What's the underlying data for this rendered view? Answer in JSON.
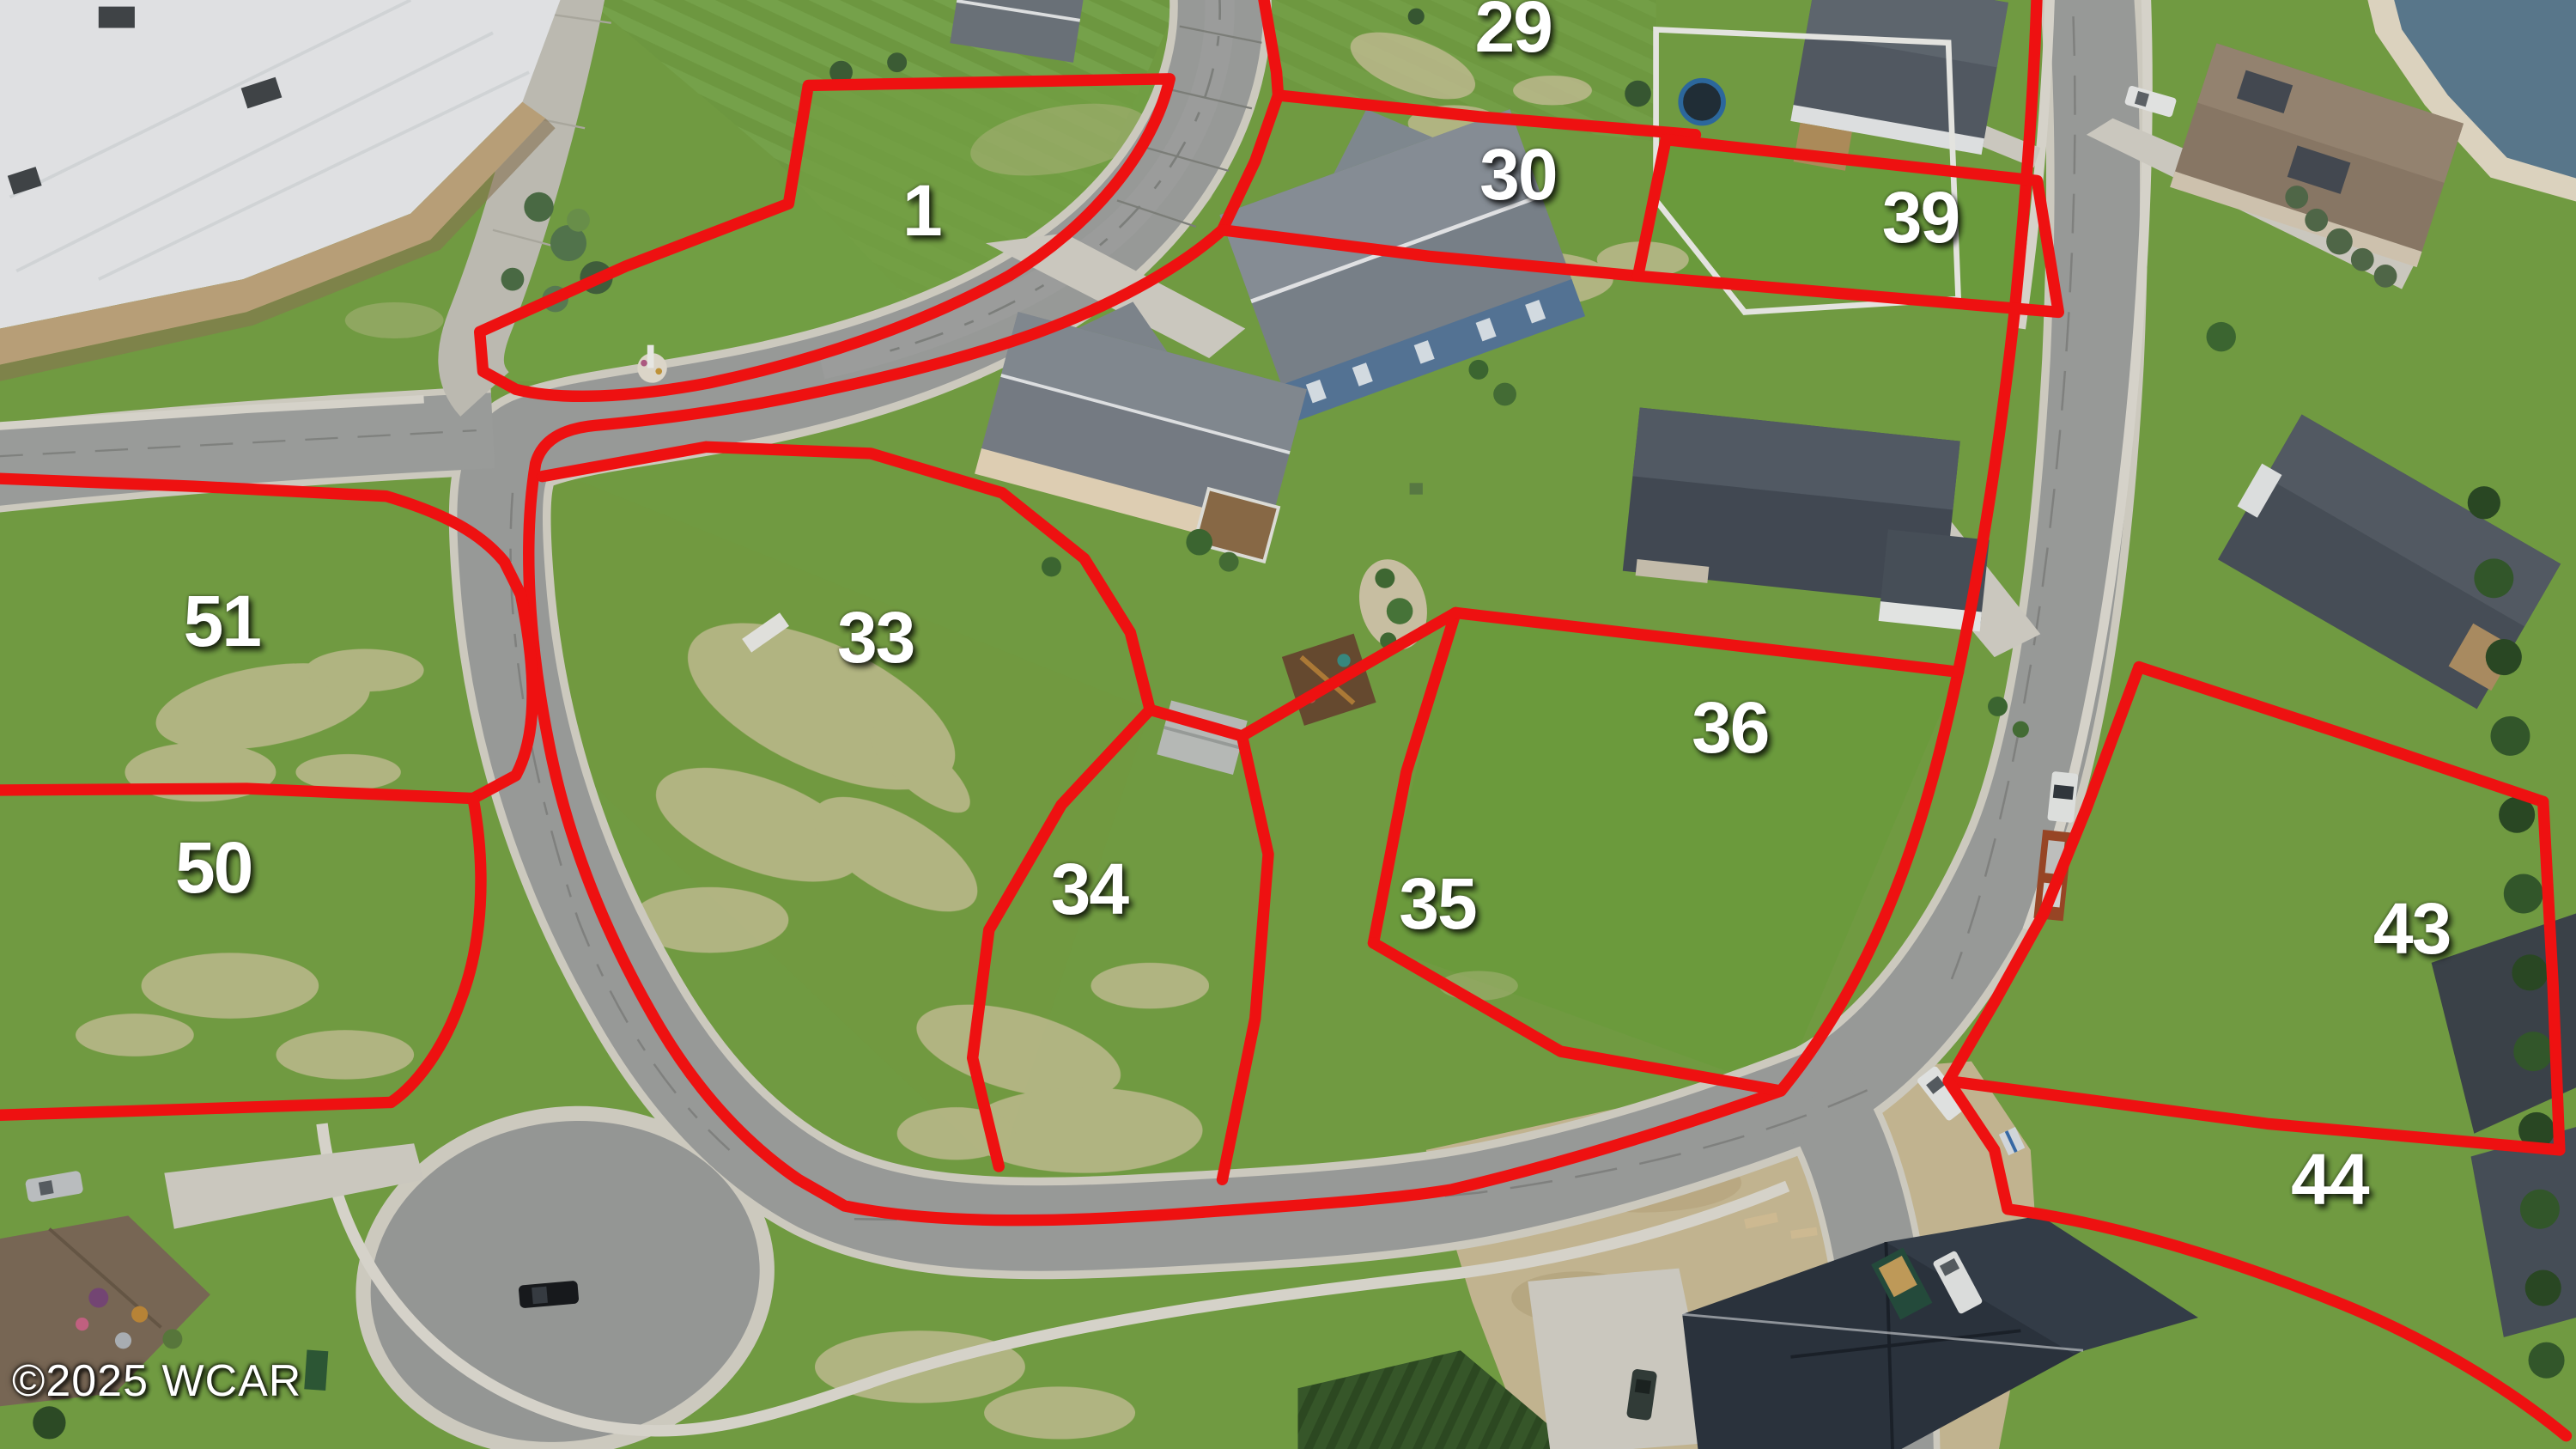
{
  "watermark": "©2025 WCAR",
  "lots": [
    {
      "id": "1",
      "label": "1",
      "x_pct": 35.78,
      "y_pct": 14.51
    },
    {
      "id": "29",
      "label": "29",
      "x_pct": 58.74,
      "y_pct": 1.81
    },
    {
      "id": "30",
      "label": "30",
      "x_pct": 58.93,
      "y_pct": 12.02
    },
    {
      "id": "39",
      "label": "39",
      "x_pct": 74.55,
      "y_pct": 14.97
    },
    {
      "id": "33",
      "label": "33",
      "x_pct": 33.99,
      "y_pct": 43.99
    },
    {
      "id": "34",
      "label": "34",
      "x_pct": 42.28,
      "y_pct": 61.34
    },
    {
      "id": "35",
      "label": "35",
      "x_pct": 55.8,
      "y_pct": 62.36
    },
    {
      "id": "36",
      "label": "36",
      "x_pct": 67.16,
      "y_pct": 50.23
    },
    {
      "id": "43",
      "label": "43",
      "x_pct": 93.62,
      "y_pct": 64.06
    },
    {
      "id": "44",
      "label": "44",
      "x_pct": 90.43,
      "y_pct": 81.41
    },
    {
      "id": "50",
      "label": "50",
      "x_pct": 8.29,
      "y_pct": 59.86
    },
    {
      "id": "51",
      "label": "51",
      "x_pct": 8.61,
      "y_pct": 42.86
    }
  ],
  "colors": {
    "boundary": "#ee1111",
    "label": "#ffffff",
    "grass": "#76a345",
    "road": "#a0a2a0",
    "concrete": "#d6d3c9",
    "water": "#5e7d92"
  }
}
